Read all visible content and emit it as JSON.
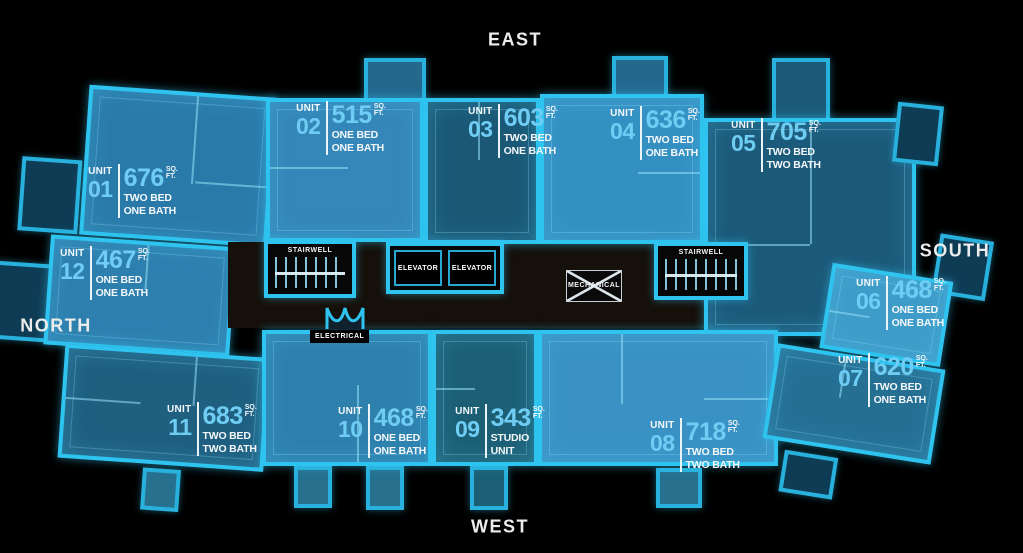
{
  "compass": {
    "north": "NORTH",
    "south": "SOUTH",
    "east": "EAST",
    "west": "WEST"
  },
  "units": [
    {
      "label": "UNIT",
      "number": "01",
      "sqft": "676",
      "sq": "SQ.",
      "ft": "FT.",
      "type1": "TWO BED",
      "type2": "ONE BATH"
    },
    {
      "label": "UNIT",
      "number": "02",
      "sqft": "515",
      "sq": "SQ.",
      "ft": "FT.",
      "type1": "ONE BED",
      "type2": "ONE BATH"
    },
    {
      "label": "UNIT",
      "number": "03",
      "sqft": "603",
      "sq": "SQ.",
      "ft": "FT.",
      "type1": "TWO BED",
      "type2": "ONE BATH"
    },
    {
      "label": "UNIT",
      "number": "04",
      "sqft": "636",
      "sq": "SQ.",
      "ft": "FT.",
      "type1": "TWO BED",
      "type2": "ONE BATH"
    },
    {
      "label": "UNIT",
      "number": "05",
      "sqft": "705",
      "sq": "SQ.",
      "ft": "FT.",
      "type1": "TWO BED",
      "type2": "TWO BATH"
    },
    {
      "label": "UNIT",
      "number": "06",
      "sqft": "468",
      "sq": "SQ.",
      "ft": "FT.",
      "type1": "ONE BED",
      "type2": "ONE BATH"
    },
    {
      "label": "UNIT",
      "number": "07",
      "sqft": "620",
      "sq": "SQ.",
      "ft": "FT.",
      "type1": "TWO BED",
      "type2": "ONE BATH"
    },
    {
      "label": "UNIT",
      "number": "08",
      "sqft": "718",
      "sq": "SQ.",
      "ft": "FT.",
      "type1": "TWO BED",
      "type2": "TWO BATH"
    },
    {
      "label": "UNIT",
      "number": "09",
      "sqft": "343",
      "sq": "SQ.",
      "ft": "FT.",
      "type1": "STUDIO",
      "type2": "UNIT"
    },
    {
      "label": "UNIT",
      "number": "10",
      "sqft": "468",
      "sq": "SQ.",
      "ft": "FT.",
      "type1": "ONE BED",
      "type2": "ONE BATH"
    },
    {
      "label": "UNIT",
      "number": "11",
      "sqft": "683",
      "sq": "SQ.",
      "ft": "FT.",
      "type1": "TWO BED",
      "type2": "TWO BATH"
    },
    {
      "label": "UNIT",
      "number": "12",
      "sqft": "467",
      "sq": "SQ.",
      "ft": "FT.",
      "type1": "ONE BED",
      "type2": "ONE BATH"
    }
  ],
  "services": {
    "stairwell_left": "STAIRWELL",
    "stairwell_right": "STAIRWELL",
    "elevator_left": "ELEVATOR",
    "elevator_right": "ELEVATOR",
    "mechanical": "MECHANICAL",
    "electrical": "ELECTRICAL"
  },
  "colors": {
    "background": "#000000",
    "outline_cyan": "#2fc3ef",
    "unit_number_cyan": "#6fcdf4",
    "label_text": "#ffffff"
  }
}
